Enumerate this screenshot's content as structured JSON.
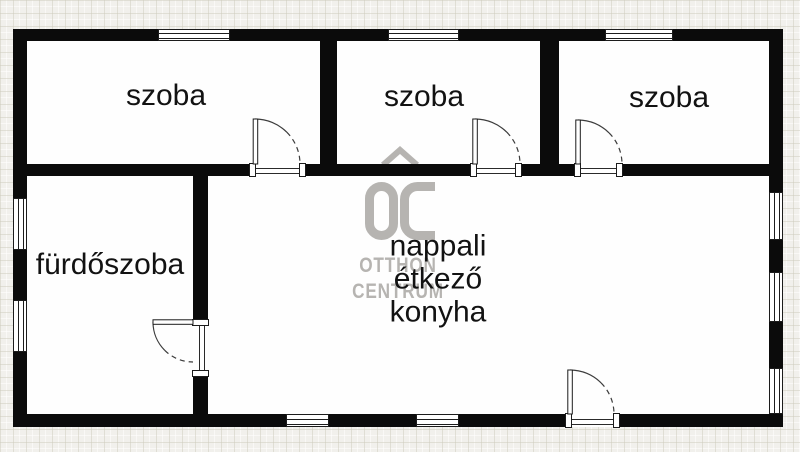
{
  "labels": {
    "room1": "szoba",
    "room2": "szoba",
    "room3": "szoba",
    "bathroom": "fürdőszoba",
    "living": [
      "nappali",
      "étkező",
      "konyha"
    ]
  },
  "watermark": {
    "logo": "OC",
    "line1": "OTTHON",
    "line2": "CENTRUM"
  },
  "colors": {
    "wall": "#0b0b0b",
    "background": "#f1f0ec",
    "floor": "#fefefe",
    "text": "#121212",
    "watermark": "#b6b4b1"
  }
}
